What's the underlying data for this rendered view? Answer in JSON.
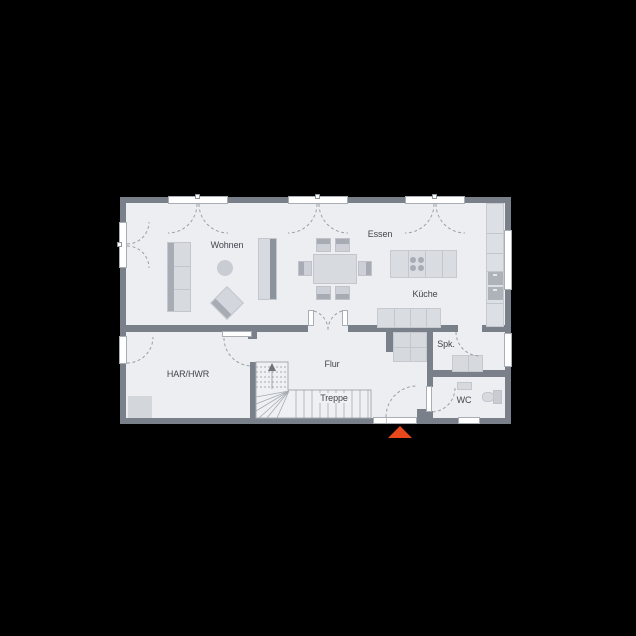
{
  "plan": {
    "rooms": {
      "wohnen": {
        "label": "Wohnen"
      },
      "essen": {
        "label": "Essen"
      },
      "kueche": {
        "label": "Küche"
      },
      "spk": {
        "label": "Spk."
      },
      "har_hwr": {
        "label": "HAR/HWR"
      },
      "flur": {
        "label": "Flur"
      },
      "treppe": {
        "label": "Treppe"
      },
      "wc": {
        "label": "WC"
      }
    },
    "markers": {
      "entrance_arrow_icon": "entrance-direction-arrow",
      "stair_arrow_icon": "stair-up-arrow"
    },
    "colors": {
      "background": "#000000",
      "wall": "#798089",
      "floor": "#edeef2",
      "furniture": "#d7dade",
      "furniture_accent": "#a7acb4",
      "window_frame": "#ffffff",
      "entrance_arrow": "#e8481c",
      "label_text": "#41464d"
    }
  }
}
